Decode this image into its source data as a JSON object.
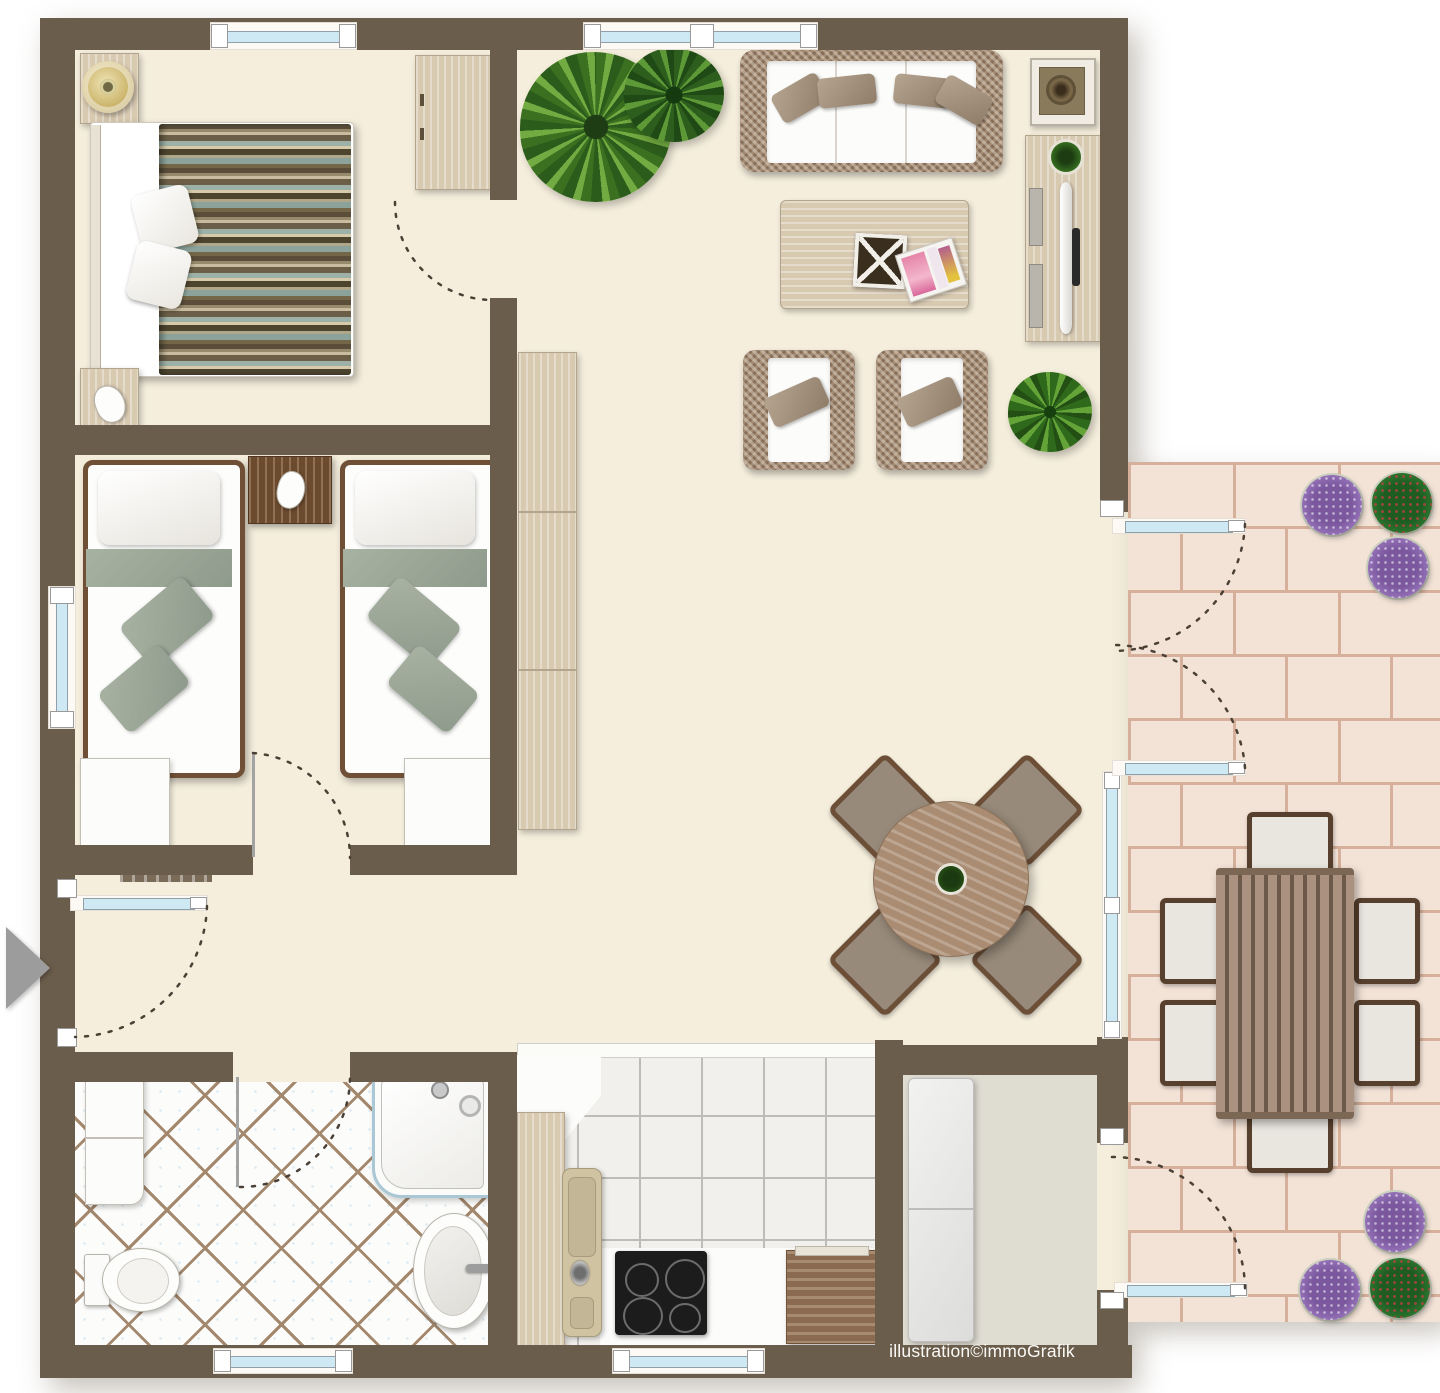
{
  "watermark": {
    "text": "illustration©immoGrafik"
  },
  "palette": {
    "wall": "#6b5d4b",
    "floor": "#f5eedd",
    "glass": "#cfe9f4",
    "wicker": "#a38a73",
    "cushion": "#fcfcfb",
    "pillow_taupe": "#9d8b76",
    "sage_green": "#9ca795",
    "wood_light": "#d8c9b1",
    "wood_mid": "#a98c72",
    "wood_dark": "#6b4a2e",
    "bath_grout": "#a3886d",
    "kitchen_tile_line": "#bcbcba",
    "patio_brick": "#f3e3d7",
    "patio_grout": "#d6b09a",
    "storage_floor": "#dfdcd2",
    "plant_green": "#3a701f",
    "flower_purple": "#9a77bd",
    "arrow": "#9c9c9c",
    "swing_line": "#4a4036"
  },
  "areas": {
    "bedroom": {
      "items": [
        "double-bed-striped-duvet",
        "white-pillows",
        "nightstand-with-lamp",
        "nightstand-with-phone",
        "wardrobe"
      ]
    },
    "kids_bedroom": {
      "items": [
        "single-bed-left",
        "single-bed-right",
        "shared-nightstand-with-phone",
        "foot-cabinet-left",
        "foot-cabinet-right",
        "radiator"
      ]
    },
    "bathroom": {
      "items": [
        "washing-machine",
        "toilet",
        "shower",
        "washbasin"
      ]
    },
    "kitchen": {
      "items": [
        "counter",
        "sink",
        "cooktop",
        "base-cabinet"
      ]
    },
    "living_dining": {
      "items": [
        "palm-plant",
        "leafy-plant",
        "wicker-sofa",
        "side-table",
        "tv-sideboard",
        "coffee-table-with-basket-and-magazines",
        "wicker-armchair-left",
        "wicker-armchair-right",
        "green-bush",
        "tall-cabinet",
        "round-dining-table",
        "four-dining-chairs"
      ]
    },
    "storage_room": {
      "items": [
        "tall-white-cabinet"
      ]
    },
    "patio": {
      "items": [
        "outdoor-dining-table",
        "six-outdoor-chairs",
        "flower-pots-top",
        "flower-pots-bottom"
      ]
    }
  }
}
